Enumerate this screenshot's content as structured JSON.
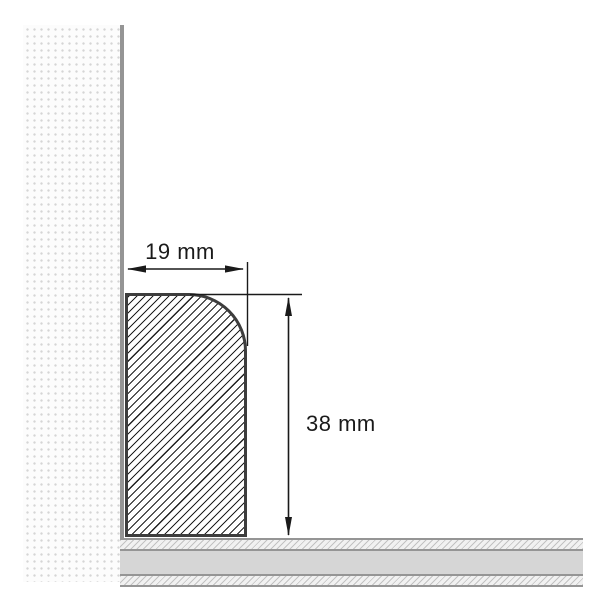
{
  "diagram": {
    "dimensions": {
      "width_label": "19 mm",
      "height_label": "38 mm"
    },
    "colors": {
      "background": "#ffffff",
      "dimension_line": "#1a1a1a",
      "profile_outline": "#3d3d3d",
      "profile_hatch": "#1f1f1f",
      "wall_line": "#959595",
      "wall_dot": "#d5d5d5",
      "floor_line": "#959595",
      "floor_solid": "#d6d6d6",
      "floor_hatch_bg": "#f1f1f1",
      "floor_hatch": "#c2c2c2"
    }
  }
}
